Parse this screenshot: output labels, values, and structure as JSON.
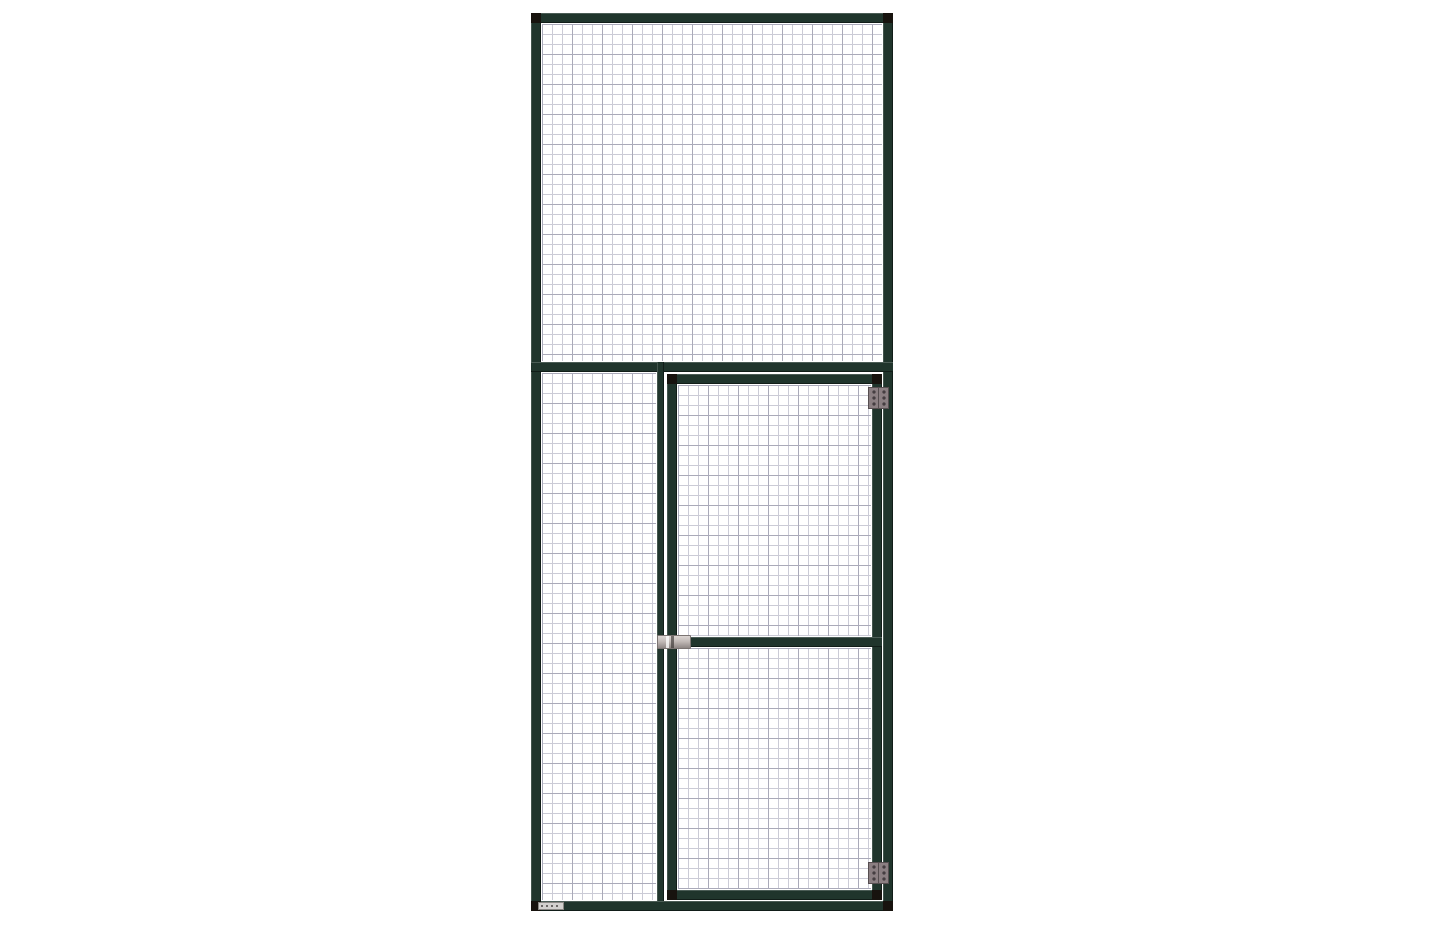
{
  "scene": {
    "type": "product-render",
    "subject": "Green steel-framed wire mesh partition panel with hinged mesh door",
    "text_content": "none visible (sticker text illegible)"
  },
  "colors": {
    "canvas-bg": "#ffffff",
    "frame": "#20352c",
    "frame-cap": "#17130e",
    "mesh-bg": "#ffffff",
    "mesh-line": "#cbcbd6",
    "mesh-line-strong": "#aaaab9",
    "hinge-body": "#8b7f82",
    "hinge-border": "#564e50",
    "hinge-screw": "#453e41",
    "latch-light": "#dcd6d3",
    "latch-dark": "#8f8785",
    "latch-border": "#7b7472",
    "label-bg": "#d3d1ce",
    "label-mark": "#6b6865"
  },
  "parts": {
    "panel": "mesh partition panel",
    "top_mesh": "upper fixed mesh section",
    "left_mesh": "lower-left fixed mesh section",
    "divider": "vertical divider post",
    "door": "hinged wire-mesh door",
    "door_upper_mesh": "door upper mesh section",
    "door_lower_mesh": "door lower mesh section",
    "hinge_top": "top door hinge",
    "hinge_bottom": "bottom door hinge",
    "latch": "door slide latch",
    "sticker": "small product sticker"
  }
}
